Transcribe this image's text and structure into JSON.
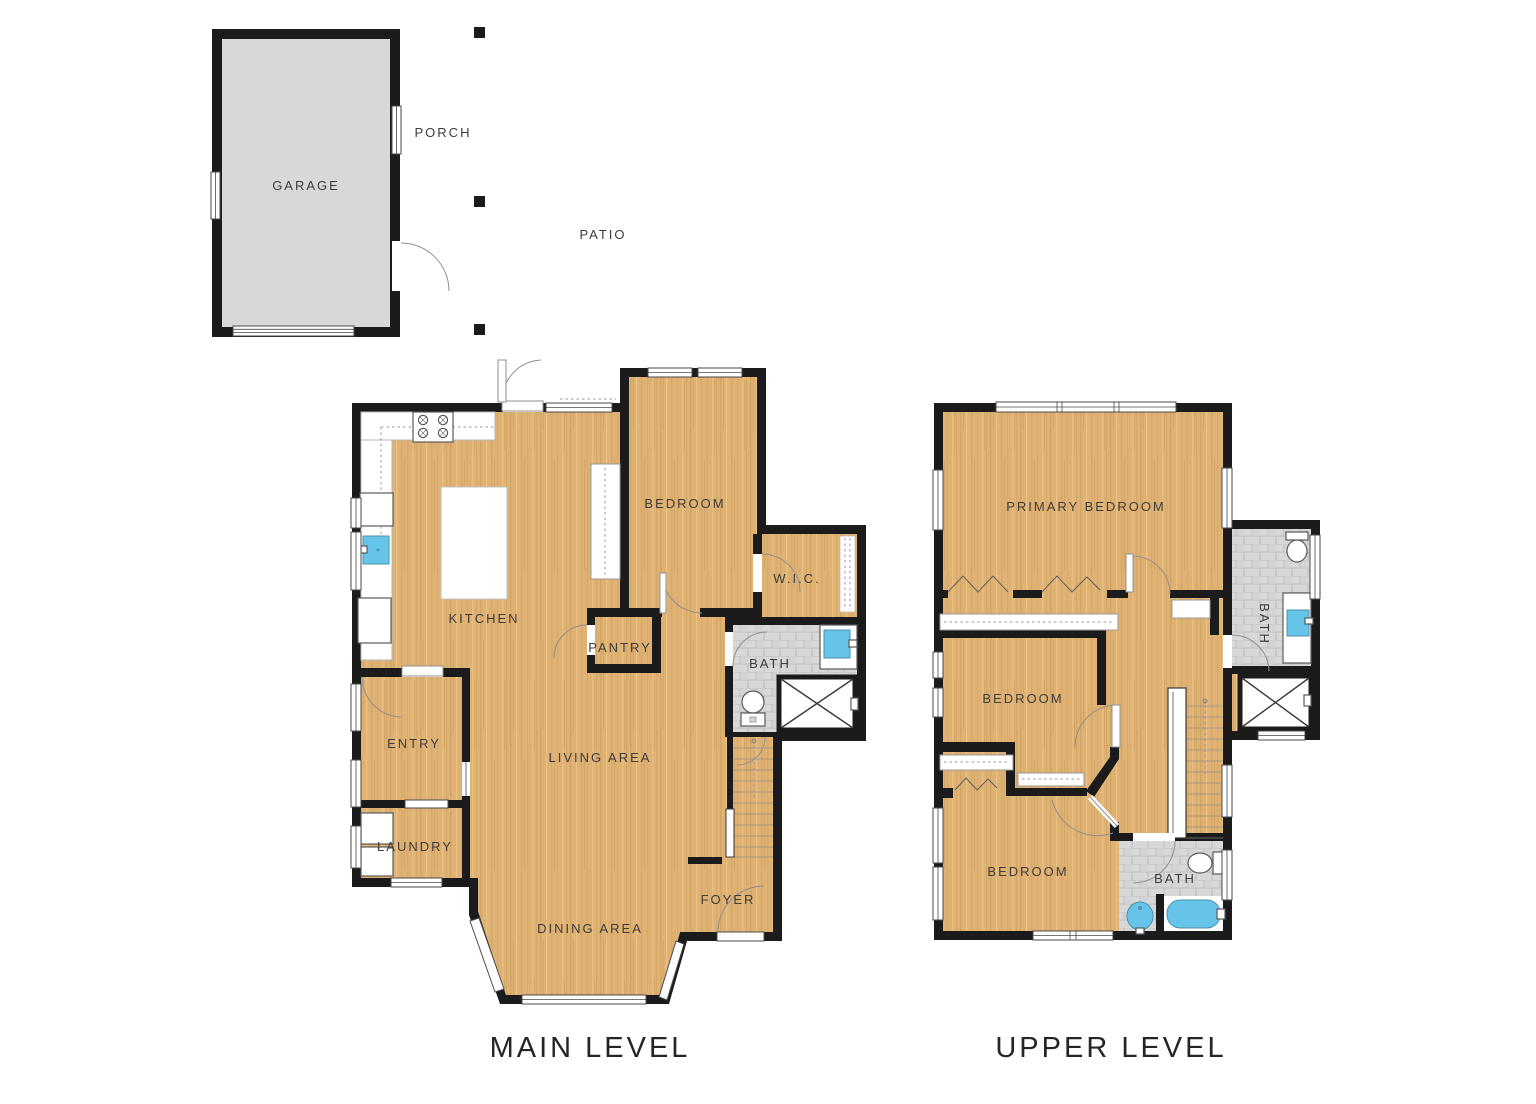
{
  "site": {
    "garage_label": "GARAGE",
    "porch_label": "PORCH",
    "patio_label": "PATIO"
  },
  "main_level": {
    "caption": "MAIN LEVEL",
    "rooms": {
      "kitchen": "KITCHEN",
      "bedroom": "BEDROOM",
      "wic": "W.I.C.",
      "pantry": "PANTRY",
      "bath": "BATH",
      "entry": "ENTRY",
      "living": "LIVING AREA",
      "laundry": "LAUNDRY",
      "dining": "DINING AREA",
      "foyer": "FOYER"
    }
  },
  "upper_level": {
    "caption": "UPPER LEVEL",
    "rooms": {
      "primary": "PRIMARY BEDROOM",
      "bedroom_mid": "BEDROOM",
      "bedroom_bottom": "BEDROOM",
      "bath_ensuite": "BATH",
      "bath_hall": "BATH"
    }
  },
  "colors": {
    "wood": "#dfb273",
    "wall": "#1b1b1b",
    "tile": "#d8d8d8",
    "garage": "#d8d8d8",
    "blue": "#67c4e9"
  }
}
